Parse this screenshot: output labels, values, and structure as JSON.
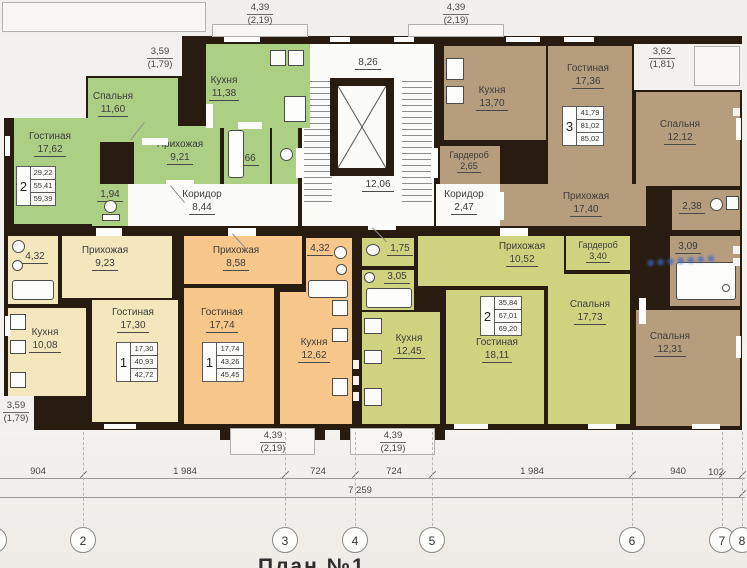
{
  "caption": "План №1",
  "watermark_text": "●●●●●●●",
  "stairwell": {
    "upper": "8,26",
    "lower": "12,06"
  },
  "corridor_left": {
    "name": "Коридор",
    "area": "8,44"
  },
  "corridor_right": {
    "name": "Коридор",
    "area": "2,47"
  },
  "apt_green": {
    "type": "2",
    "stamp": [
      "29,22",
      "55,41",
      "59,39"
    ],
    "living": {
      "name": "Гостиная",
      "area": "17,62"
    },
    "bedroom": {
      "name": "Спальня",
      "area": "11,60"
    },
    "kitchen": {
      "name": "Кухня",
      "area": "11,38"
    },
    "hall": {
      "name": "Прихожая",
      "area": "9,21"
    },
    "bath": {
      "area": "3,66"
    },
    "wc": {
      "area": "1,94"
    }
  },
  "apt_brown": {
    "type": "3",
    "stamp": [
      "41,79",
      "81,02",
      "85,02"
    ],
    "kitchen": {
      "name": "Кухня",
      "area": "13,70"
    },
    "living": {
      "name": "Гостиная",
      "area": "17,36"
    },
    "bedroom1": {
      "name": "Спальня",
      "area": "12,12"
    },
    "bedroom2": {
      "name": "Спальня",
      "area": "12,31"
    },
    "wardrobe": {
      "name": "Гардероб",
      "area": "2,65"
    },
    "hall": {
      "name": "Прихожая",
      "area": "17,40"
    },
    "bath1": {
      "area": "2,38"
    },
    "bath2": {
      "area": "3,09"
    }
  },
  "apt_cream": {
    "type": "1",
    "stamp": [
      "17,30",
      "40,93",
      "42,72"
    ],
    "living": {
      "name": "Гостиная",
      "area": "17,30"
    },
    "kitchen": {
      "name": "Кухня",
      "area": "10,08"
    },
    "hall": {
      "name": "Прихожая",
      "area": "9,23"
    },
    "bath": {
      "area": "4,32"
    }
  },
  "apt_orange": {
    "type": "1",
    "stamp": [
      "17,74",
      "43,26",
      "45,45"
    ],
    "living": {
      "name": "Гостиная",
      "area": "17,74"
    },
    "kitchen": {
      "name": "Кухня",
      "area": "12,62"
    },
    "hall": {
      "name": "Прихожая",
      "area": "8,58"
    },
    "bath": {
      "area": "4,32"
    }
  },
  "apt_olive": {
    "type": "2",
    "stamp": [
      "35,84",
      "67,01",
      "69,20"
    ],
    "living": {
      "name": "Гостиная",
      "area": "18,11"
    },
    "kitchen": {
      "name": "Кухня",
      "area": "12,45"
    },
    "bedroom": {
      "name": "Спальня",
      "area": "17,73"
    },
    "hall": {
      "name": "Прихожая",
      "area": "10,52"
    },
    "wardrobe": {
      "name": "Гардероб",
      "area": "3,40"
    },
    "wc": {
      "area": "1,75"
    },
    "bath": {
      "area": "3,05"
    }
  },
  "dims": {
    "top_left": {
      "v": "3,59",
      "s": "(1,79)"
    },
    "top_mid1": {
      "v": "4,39",
      "s": "(2,19)"
    },
    "top_mid2": {
      "v": "4,39",
      "s": "(2,19)"
    },
    "top_right": {
      "v": "3,62",
      "s": "(1,81)"
    },
    "bottom_left": {
      "v": "3,59",
      "s": "(1,79)"
    },
    "bottom_mid1": {
      "v": "4,39",
      "s": "(2,19)"
    },
    "bottom_mid2": {
      "v": "4,39",
      "s": "(2,19)"
    },
    "segments": [
      "904",
      "1 984",
      "724",
      "724",
      "1 984",
      "940",
      "102"
    ],
    "total": "7 259"
  },
  "axes": [
    "1",
    "2",
    "3",
    "4",
    "5",
    "6",
    "7",
    "8"
  ]
}
